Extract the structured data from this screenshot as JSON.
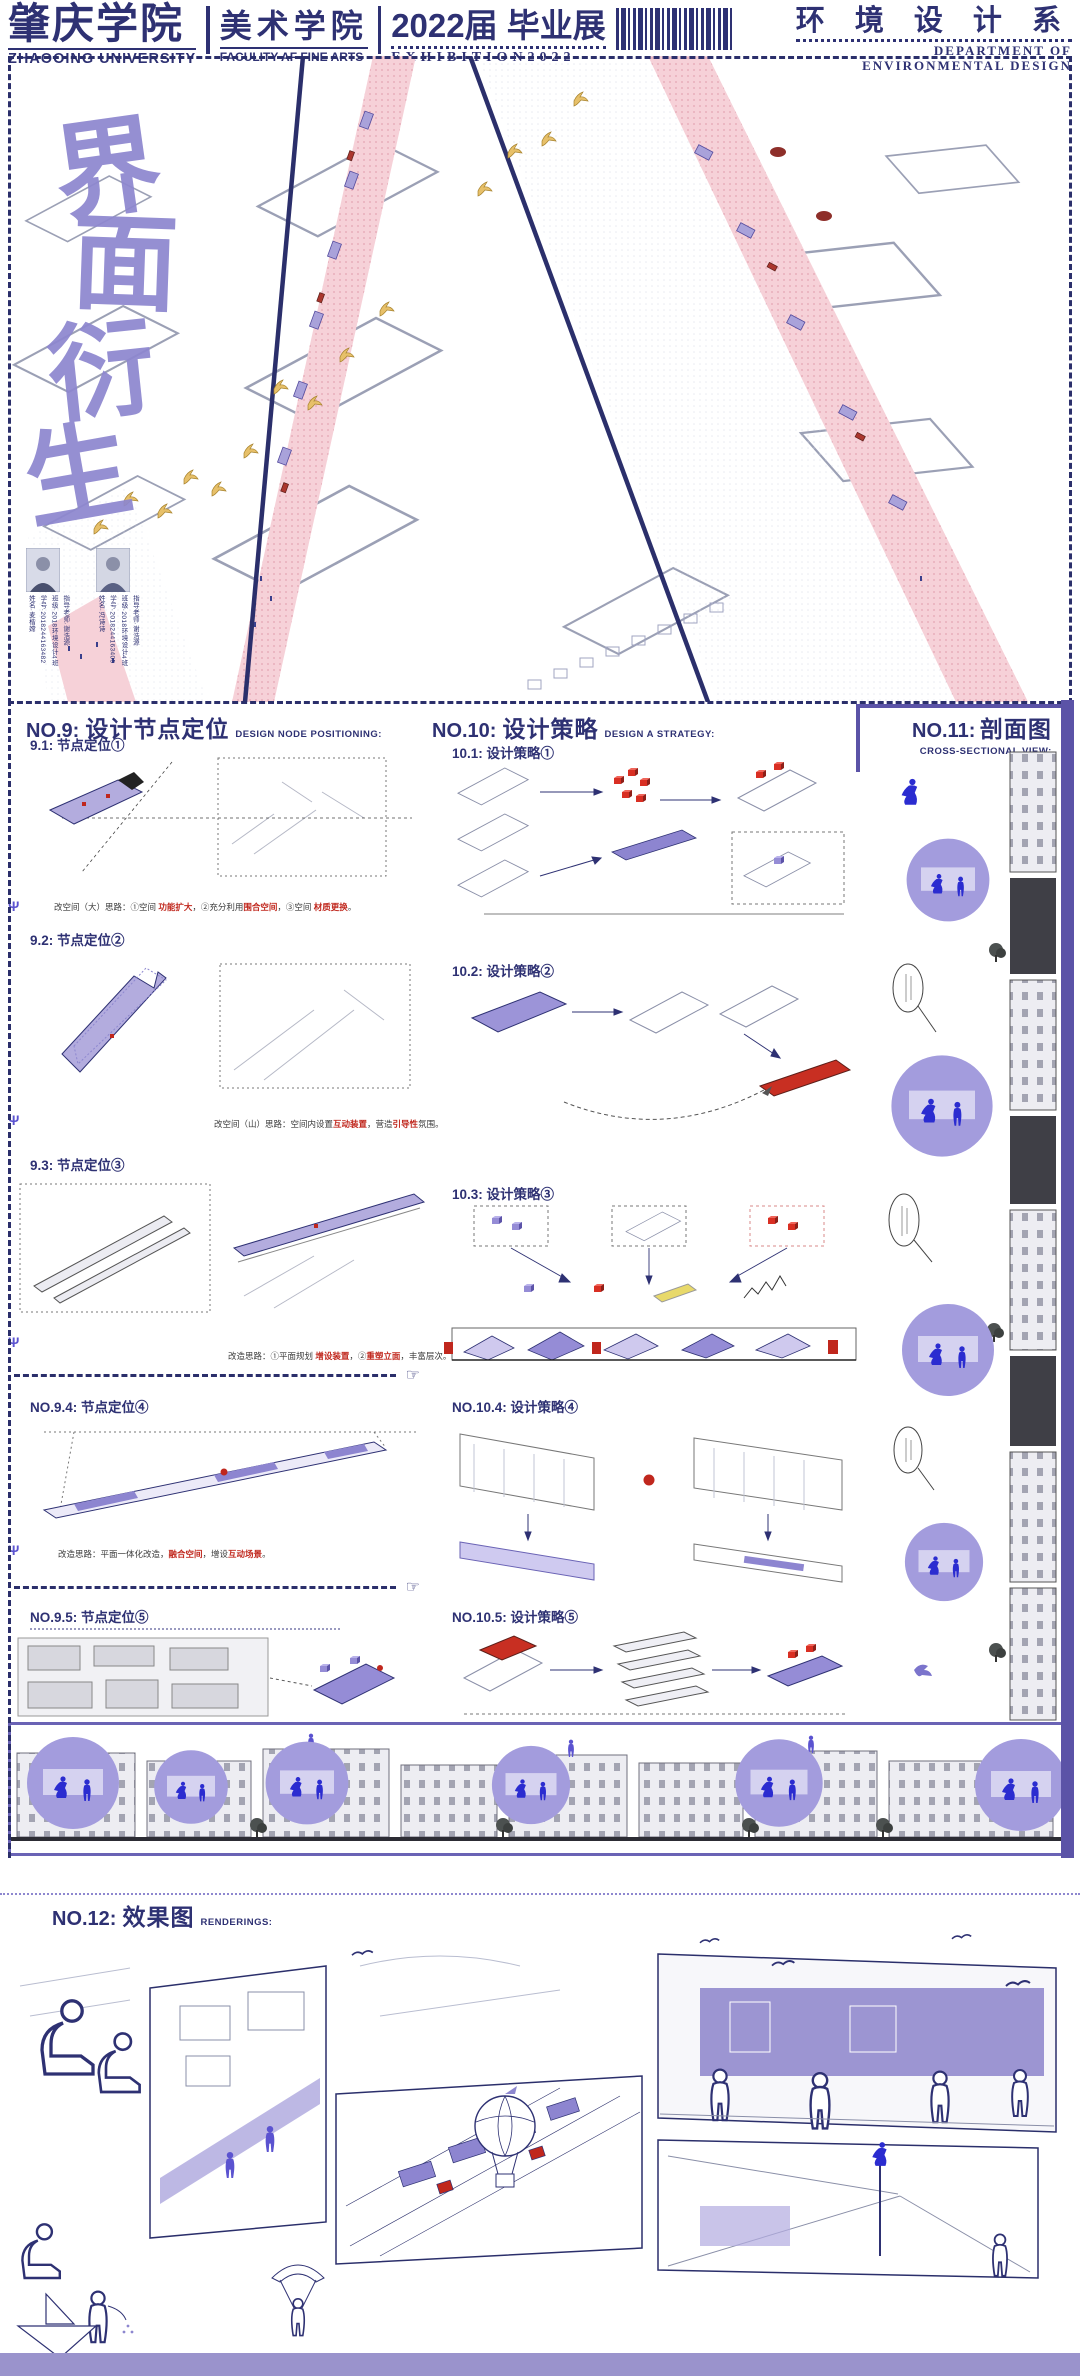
{
  "header": {
    "school_cn": "肇庆学院",
    "school_en": "ZHAOOING UNIVERSITY",
    "faculty_cn": "美术学院",
    "faculty_en": "FACULITY AF FINE ARTS",
    "edition_cn": "2022届 毕业展",
    "edition_en": "EXHIBITION2022",
    "dept_cn": "环 境 设 计 系",
    "dept_en_1": "DEPARTMENT OF",
    "dept_en_2": "ENVIRONMENTAL DESIGN"
  },
  "hero": {
    "calligraphy": [
      "界",
      "面",
      "衍",
      "生"
    ],
    "designers": [
      {
        "lines": [
          "指导老师·谢浩源",
          "班级·2018环境设计4班",
          "学号·2018244163482",
          "姓名·麦楷嫦"
        ]
      },
      {
        "lines": [
          "指导老师·谢浩源",
          "班级·2018环境设计4班",
          "学号·2018244163405",
          "姓名·冯诗诗"
        ]
      }
    ]
  },
  "no9": {
    "num": "NO.9:",
    "title": "设计节点定位",
    "subtitle": "DESIGN NODE POSITIONING:",
    "items": [
      {
        "label": "9.1: 节点定位①",
        "cap": [
          "改空间（大）思路：①空间 ",
          "功能扩大",
          "，②充分利用",
          "围合空间",
          "，③空间 ",
          "材质更换",
          "。"
        ]
      },
      {
        "label": "9.2: 节点定位②",
        "cap": [
          "改空间（山）思路：空间内设置",
          "互动装置",
          "，营造",
          "引导性",
          "氛围。"
        ]
      },
      {
        "label": "9.3: 节点定位③",
        "cap": [
          "改造思路：①平面规划 ",
          "增设装置",
          "，②",
          "重塑立面",
          "，丰富层次。"
        ]
      },
      {
        "label": "NO.9.4: 节点定位④",
        "cap": [
          "改造思路：平面一体化改造，",
          "融合空间",
          "，增设",
          "互动场景",
          "。"
        ]
      },
      {
        "label": "NO.9.5: 节点定位⑤",
        "cap": []
      }
    ]
  },
  "no10": {
    "num": "NO.10:",
    "title": "设计策略",
    "subtitle": "DESIGN A STRATEGY:",
    "items": [
      {
        "label": "10.1: 设计策略①"
      },
      {
        "label": "10.2: 设计策略②"
      },
      {
        "label": "10.3: 设计策略③"
      },
      {
        "label": "NO.10.4: 设计策略④"
      },
      {
        "label": "NO.10.5: 设计策略⑤"
      }
    ]
  },
  "no11": {
    "num": "NO.11:",
    "title": "剖面图",
    "subtitle": "CROSS-SECTIONAL VIEW:"
  },
  "no12": {
    "num": "NO.12:",
    "title": "效果图",
    "subtitle": "RENDERINGS:"
  },
  "glyphs": {
    "pointing_hand": "☞",
    "fork": "Ψ"
  },
  "colors": {
    "navy": "#2e3173",
    "accent_purple": "#8d87cf",
    "deep_purple": "#5b53a7",
    "road_pink": "#f6d1d8",
    "highlight_red": "#c0271d",
    "bird_gold": "#e7c069",
    "vignette_blue": "#2b2cd0",
    "footer_purple": "#9a93cc"
  }
}
